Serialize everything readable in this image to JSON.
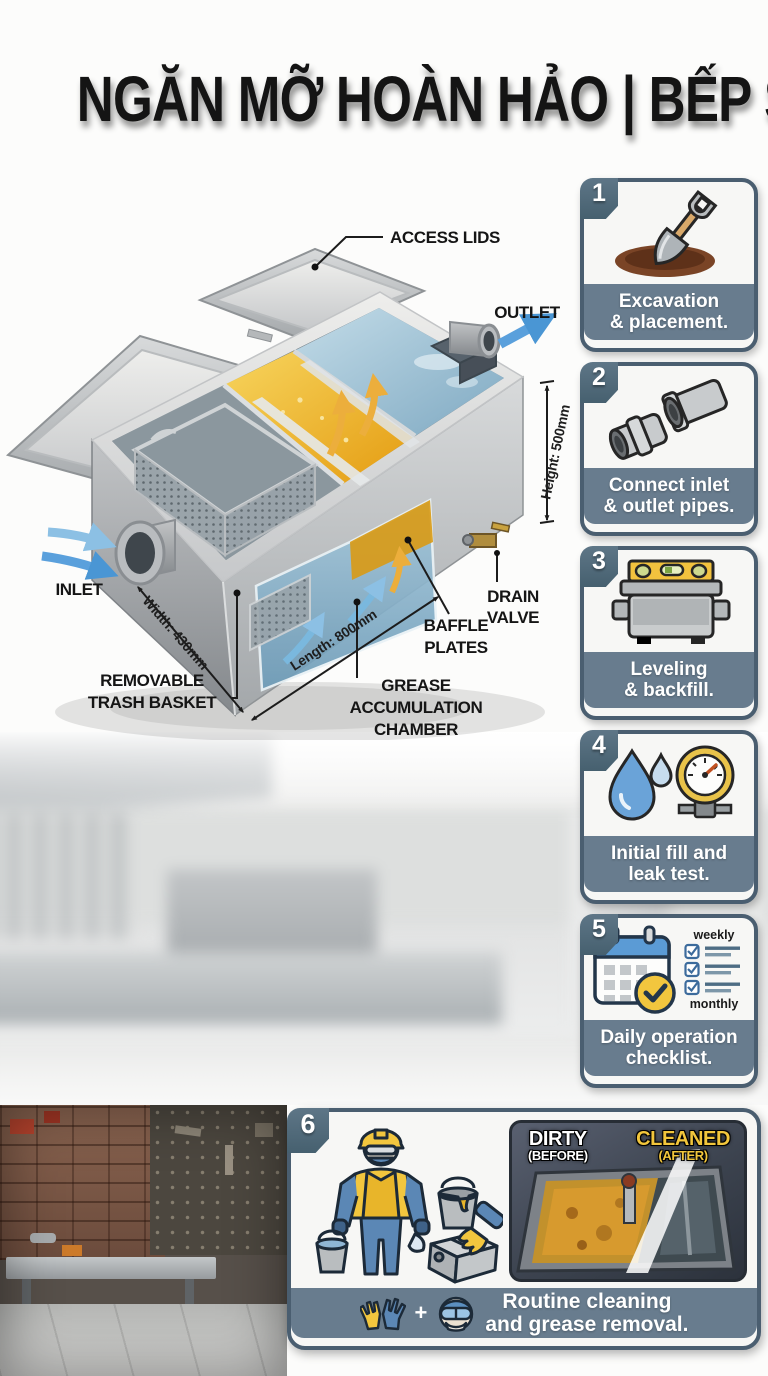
{
  "title": "NGĂN MỠ HOÀN HẢO | BẾP SẠCH NGAY",
  "diagram": {
    "access_lids": "ACCESS LIDS",
    "outlet": "OUTLET",
    "inlet": "INLET",
    "removable_1": "REMOVABLE",
    "removable_2": "TRASH BASKET",
    "drain_1": "DRAIN",
    "drain_2": "VALVE",
    "baffle_1": "BAFFLE",
    "baffle_2": "PLATES",
    "grease_1": "GREASE",
    "grease_2": "ACCUMULATION",
    "grease_3": "CHAMBER",
    "dim_width": "Width: 430mm",
    "dim_length": "Length: 800mm",
    "dim_height": "Height: 500mm"
  },
  "steps": [
    {
      "number": "1",
      "line1": "Excavation",
      "line2": "& placement."
    },
    {
      "number": "2",
      "line1": "Connect inlet",
      "line2": "& outlet pipes."
    },
    {
      "number": "3",
      "line1": "Leveling",
      "line2": "& backfill."
    },
    {
      "number": "4",
      "line1": "Initial fill and",
      "line2": "leak test."
    },
    {
      "number": "5",
      "line1": "Daily operation",
      "line2": "checklist.",
      "checklist_top": "weekly",
      "checklist_bottom": "monthly"
    },
    {
      "number": "6",
      "line1": "Routine cleaning",
      "line2": "and grease removal.",
      "plus_sign": "+",
      "before_title": "DIRTY",
      "before_sub": "(BEFORE)",
      "after_title": "CLEANED",
      "after_sub": "(AFTER)"
    }
  ],
  "colors": {
    "slate_footer": "#687c8e",
    "badge": "#506878",
    "card_border": "#4a5e70",
    "grease_amber": "#e8a31c",
    "water_blue": "#8fb6cc",
    "flow_blue": "#5aa0dc",
    "check_yellow": "#f2c63e",
    "cleaned_yellow": "#f0c53a"
  }
}
